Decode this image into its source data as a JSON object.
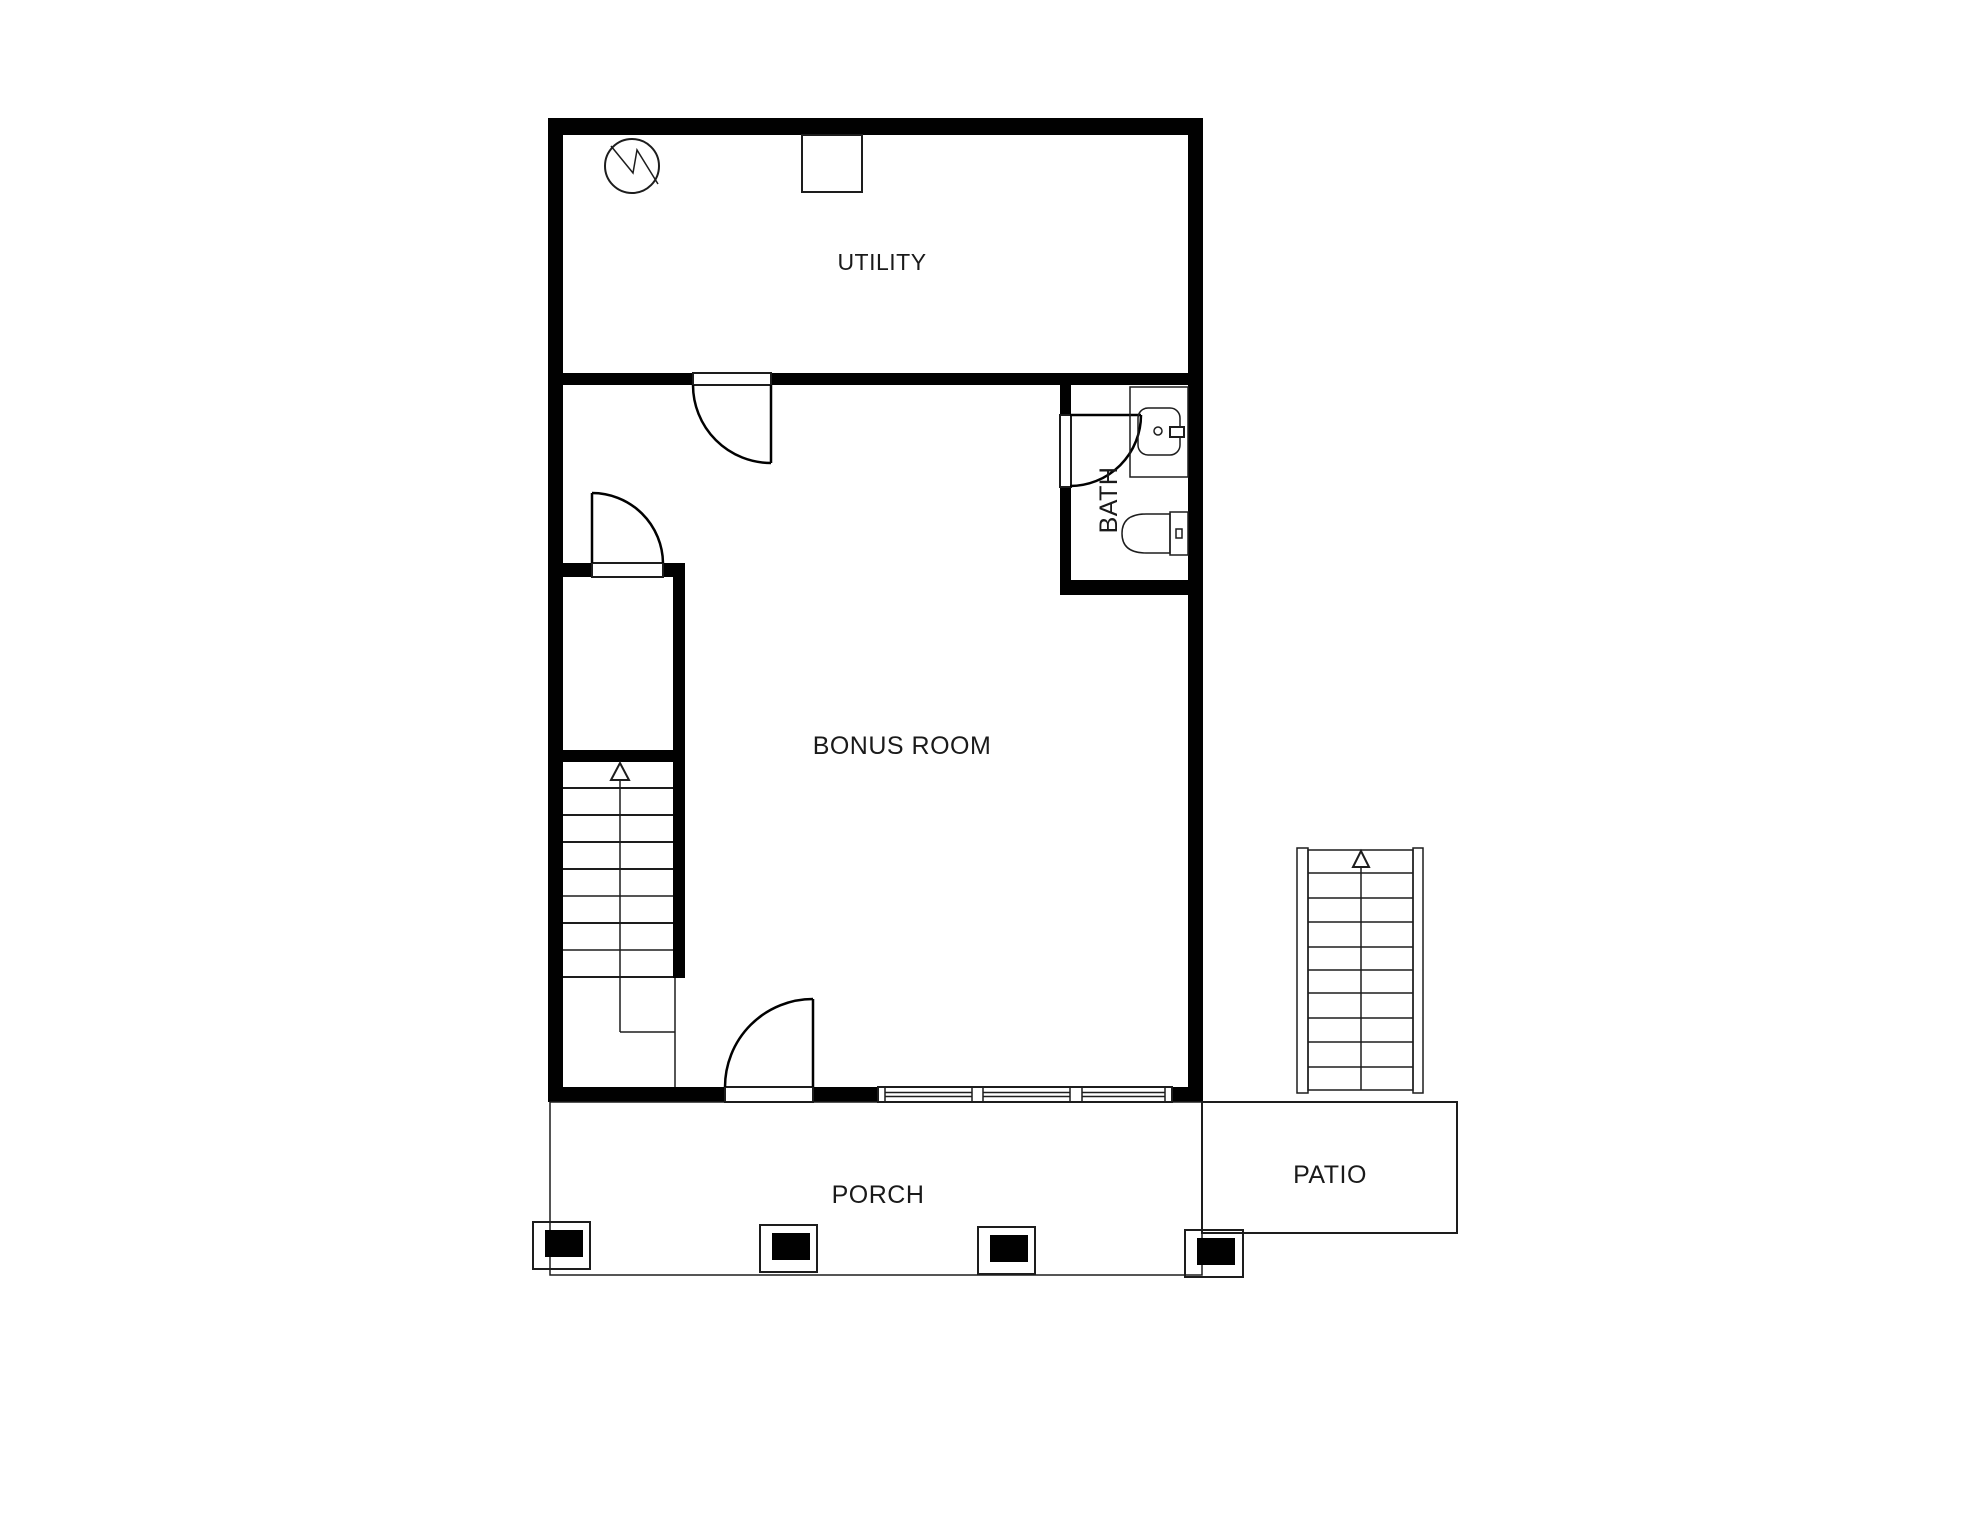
{
  "rooms": {
    "utility": {
      "label": "UTILITY"
    },
    "bonus_room": {
      "label": "BONUS ROOM"
    },
    "bath": {
      "label": "BATH"
    },
    "porch": {
      "label": "PORCH"
    },
    "patio": {
      "label": "PATIO"
    }
  },
  "stairs": {
    "interior": {
      "direction": "up",
      "tread_count": 8
    },
    "exterior": {
      "direction": "up",
      "tread_count": 10
    }
  },
  "icons": {
    "light_fixture": "circle-zigzag-icon",
    "stair_direction": "up-arrow-icon"
  },
  "colors": {
    "background": "#ffffff",
    "wall": "#010101",
    "line": "#1d1d1d",
    "text": "#1a1a1a"
  }
}
